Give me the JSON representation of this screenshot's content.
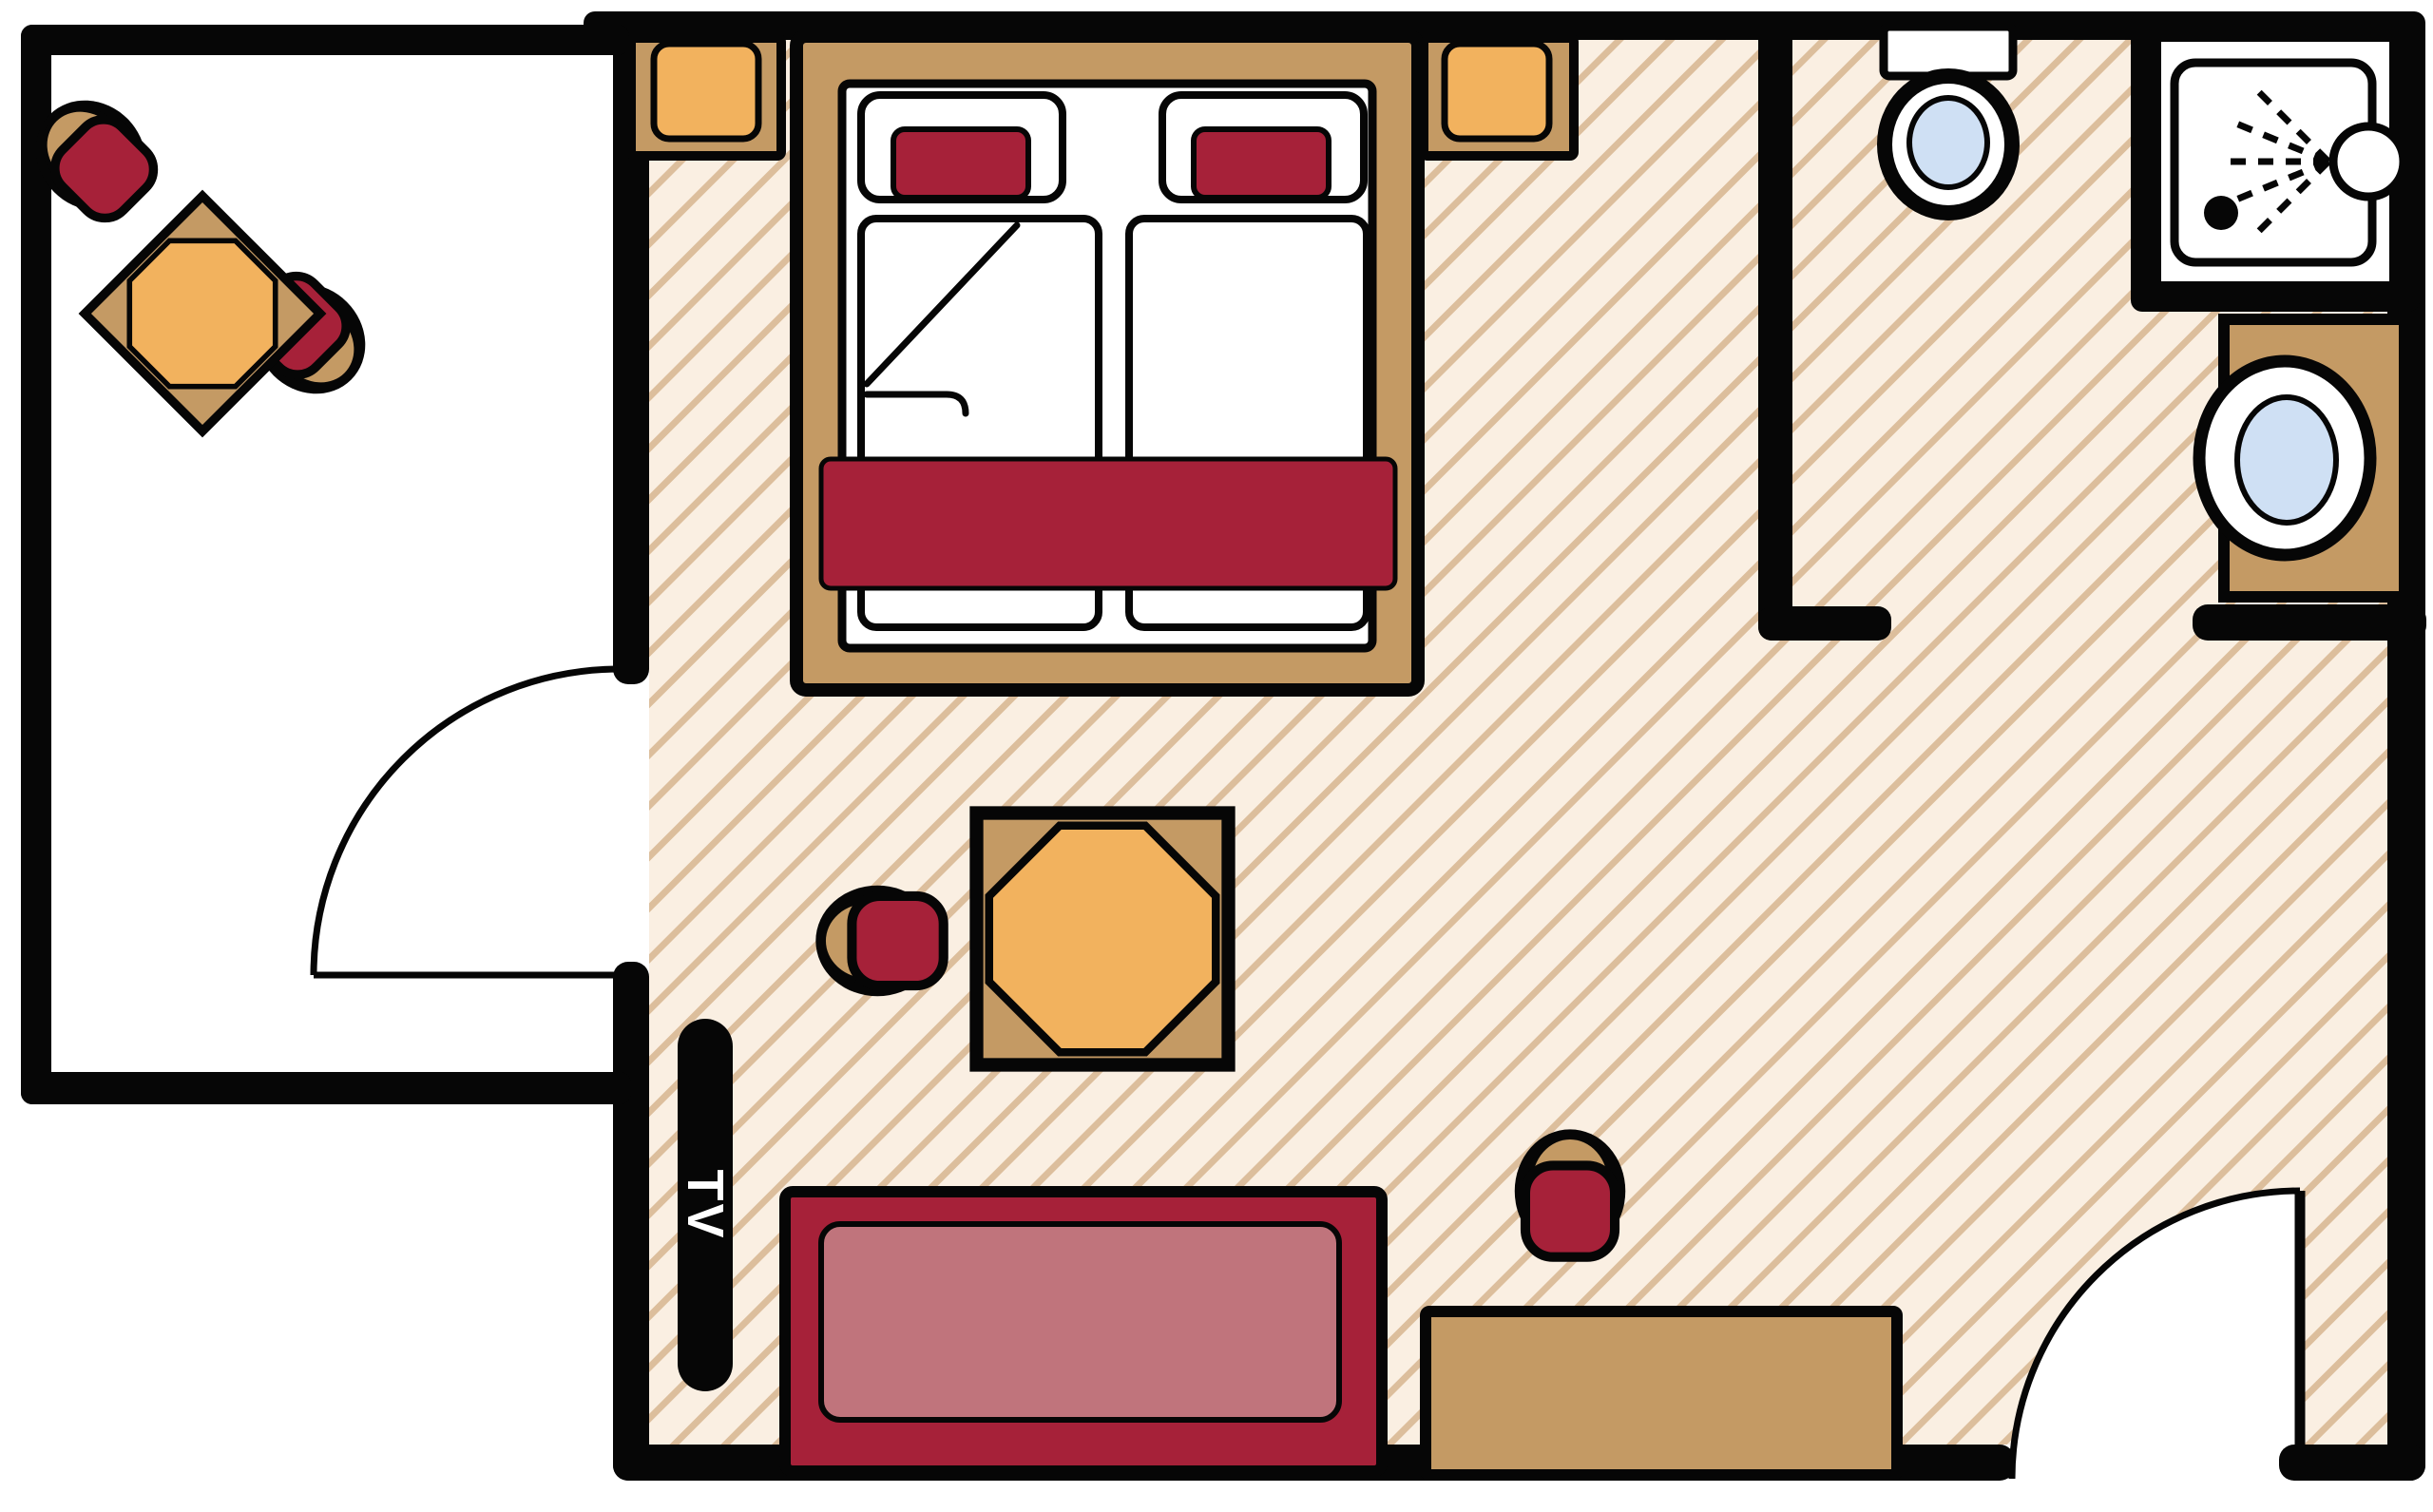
{
  "labels": {
    "tv": "TV"
  },
  "colors": {
    "wall": "#060606",
    "paper": "#ffffff",
    "floor": "#faefe2",
    "hatch": "#dcbe9c",
    "wood": "#c49a64",
    "orange": "#f2b25e",
    "crimson": "#a62139",
    "rose": "#c0747c",
    "blue": "#cfe0f4"
  },
  "furniture": {
    "balcony": [
      "bistro-table",
      "chair",
      "chair"
    ],
    "bedroom": [
      "nightstand",
      "double-bed",
      "nightstand"
    ],
    "bathroom": [
      "toilet",
      "shower",
      "washbasin"
    ],
    "living-area": [
      "tv",
      "table",
      "chair",
      "sofa",
      "desk",
      "desk-chair"
    ]
  },
  "doors": [
    "balcony-door",
    "bathroom-doorway",
    "entry-door"
  ]
}
